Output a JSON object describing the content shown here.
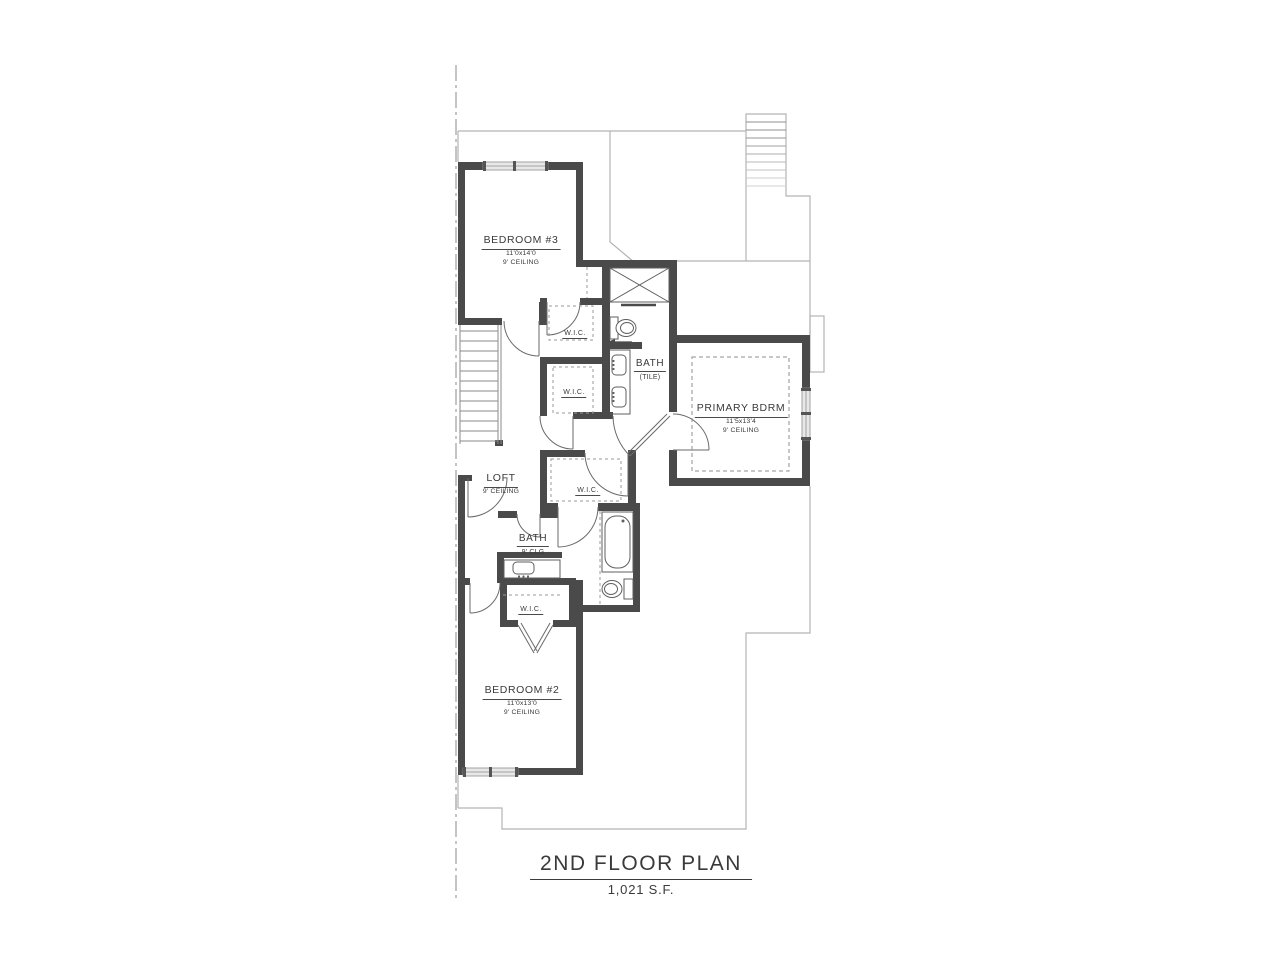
{
  "title": {
    "main": "2ND FLOOR PLAN",
    "area": "1,021 S.F."
  },
  "rooms": {
    "bedroom3": {
      "name": "BEDROOM #3",
      "dims": "11'0x14'0",
      "ceiling": "9' CEILING"
    },
    "primary": {
      "name": "PRIMARY BDRM",
      "dims": "11'5x13'4",
      "ceiling": "9' CEILING"
    },
    "bedroom2": {
      "name": "BEDROOM #2",
      "dims": "11'0x13'0",
      "ceiling": "9' CEILING"
    },
    "loft": {
      "name": "LOFT",
      "ceiling": "9' CEILING"
    },
    "bath_tile": {
      "name": "BATH",
      "note": "(TILE)"
    },
    "bath_hall": {
      "name": "BATH",
      "note": "9' CLG"
    }
  },
  "closets": [
    {
      "name": "W.I.C."
    },
    {
      "name": "W.I.C."
    },
    {
      "name": "W.I.C."
    },
    {
      "name": "W.I.C."
    }
  ],
  "colors": {
    "wall": "#4a4a4a",
    "footprint_line": "#b3b3b3",
    "fixture_line": "#5f5f5f",
    "dashed_line": "#999999",
    "text": "#3a3a3a"
  }
}
